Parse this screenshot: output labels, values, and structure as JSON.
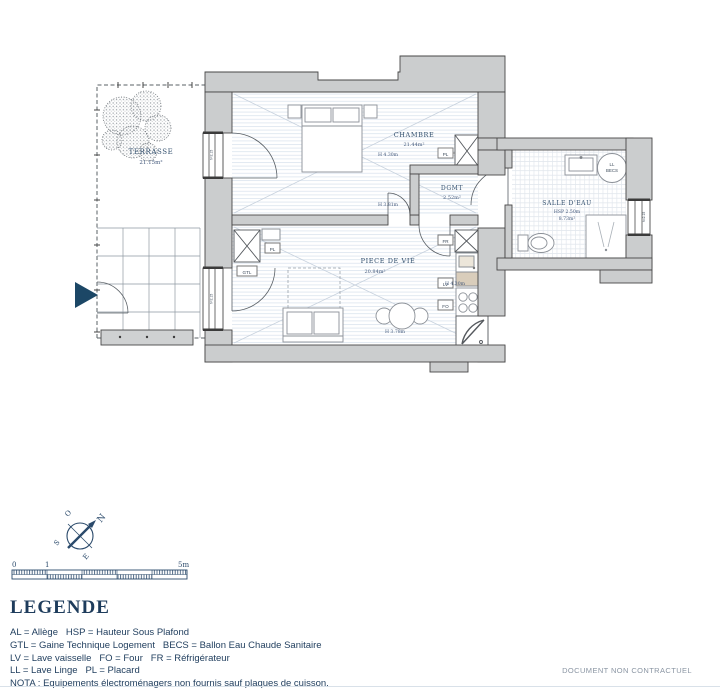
{
  "plan": {
    "terrasse": {
      "name": "TERRASSE",
      "area": "21.15m²"
    },
    "chambre": {
      "name": "CHAMBRE",
      "area": "21.44m²",
      "height": "H 4.30m"
    },
    "dgmt": {
      "name": "DGMT",
      "area": "2.52m²",
      "height": "H 3.81m"
    },
    "piece_de_vie": {
      "name": "PIECE DE VIE",
      "area": "20.84m²",
      "height_a": "H 4.30m",
      "height_b": "H 3.78m"
    },
    "salle_deau": {
      "name": "SALLE D'EAU",
      "hsp": "HSP 2.50m",
      "area": "8.73m²"
    },
    "labels": {
      "pl": "PL",
      "gtl": "GTL",
      "fr": "FR",
      "lv": "LV",
      "fo": "FO",
      "ll": "LL",
      "becs": "BECS"
    },
    "window_note": "h=2.15"
  },
  "compass": {
    "n": "N",
    "s": "S",
    "e": "E",
    "o": "O"
  },
  "scale": {
    "zero": "0",
    "one": "1",
    "five": "5m"
  },
  "legend": {
    "title": "LEGENDE",
    "line1": "AL = Allège   HSP = Hauteur Sous Plafond",
    "line2": "GTL = Gaine Technique Logement   BECS = Ballon Eau Chaude Sanitaire",
    "line3": "LV = Lave vaisselle   FO = Four   FR = Réfrigérateur",
    "line4": "LL = Lave Linge   PL = Placard",
    "line5": "NOTA : Equipements électroménagers non fournis sauf plaques de cuisson."
  },
  "footer": {
    "disclaimer": "DOCUMENT NON CONTRACTUEL"
  }
}
